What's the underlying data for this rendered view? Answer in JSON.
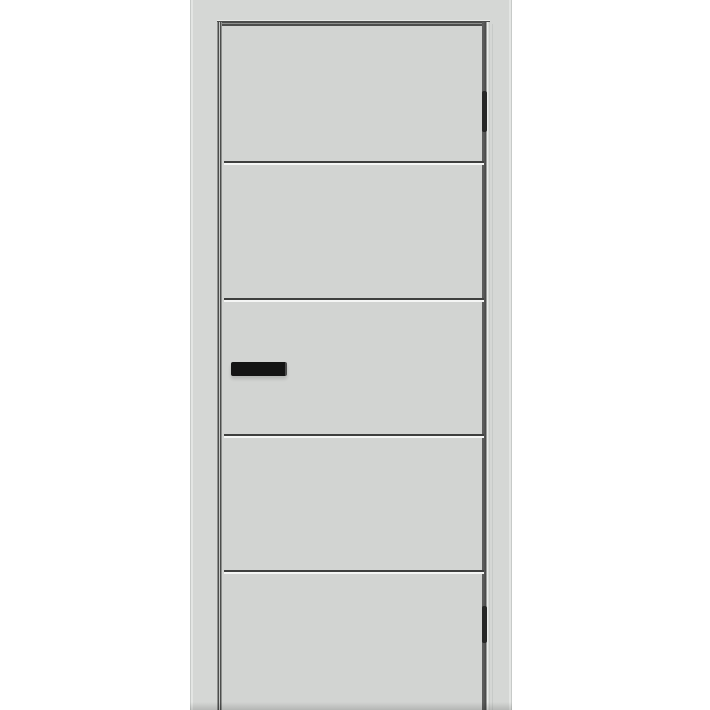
{
  "scene": {
    "description": "Product photo of a light grey flush interior door with four horizontal grooves dividing it into five panels, a black bar handle on the left stile and two dark hinges on the right edge, shown inside a matching light grey frame on a white background",
    "object": "interior door with frame",
    "view": "front, full height, cropped at bottom"
  },
  "door": {
    "finish": "light grey matte",
    "panel_count": 5,
    "groove_count": 4,
    "grooves_y": [
      161,
      298,
      434,
      570
    ],
    "handle": {
      "type": "horizontal bar handle",
      "side": "left",
      "color_name": "black"
    },
    "hinges": [
      {
        "position": "upper",
        "y": 91,
        "height": 41
      },
      {
        "position": "lower",
        "y": 606,
        "height": 37
      }
    ],
    "hinge_side": "right"
  },
  "colors": {
    "background": "#ffffff",
    "frame": "#d5d7d5",
    "slab": "#d2d4d2",
    "gap-dark": "#4c4d4c",
    "gap-mid": "#8e908e",
    "gap-light": "#e9ebe9",
    "groove-dark": "#3e3f3e",
    "groove-light": "#f5f6f5",
    "handle": "#141414",
    "hinge": "#262726",
    "edge": "#c7cac8",
    "edge-light": "#e3e5e3"
  }
}
